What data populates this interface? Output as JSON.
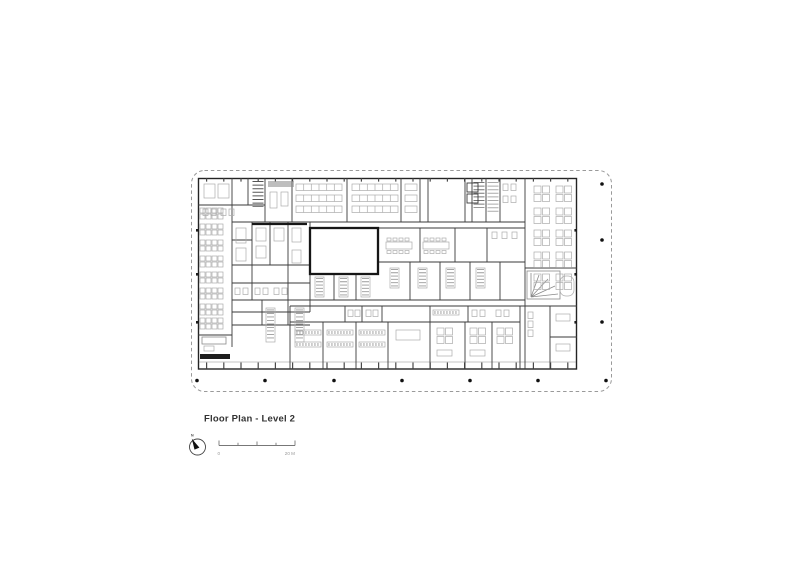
{
  "sheet": {
    "background": "#ffffff",
    "title": "Floor Plan - Level 2",
    "north_arrow": {
      "label": "N"
    },
    "scale_bar": {
      "start_label": "0",
      "end_label": "20 M"
    },
    "colors": {
      "walls": "#2e2e2e",
      "thick_walls": "#161616",
      "furniture": "#acacac",
      "site_boundary": "#9a9a9a",
      "title_text": "#333333",
      "scale_text": "#999999",
      "column_dots": "#111111"
    }
  }
}
